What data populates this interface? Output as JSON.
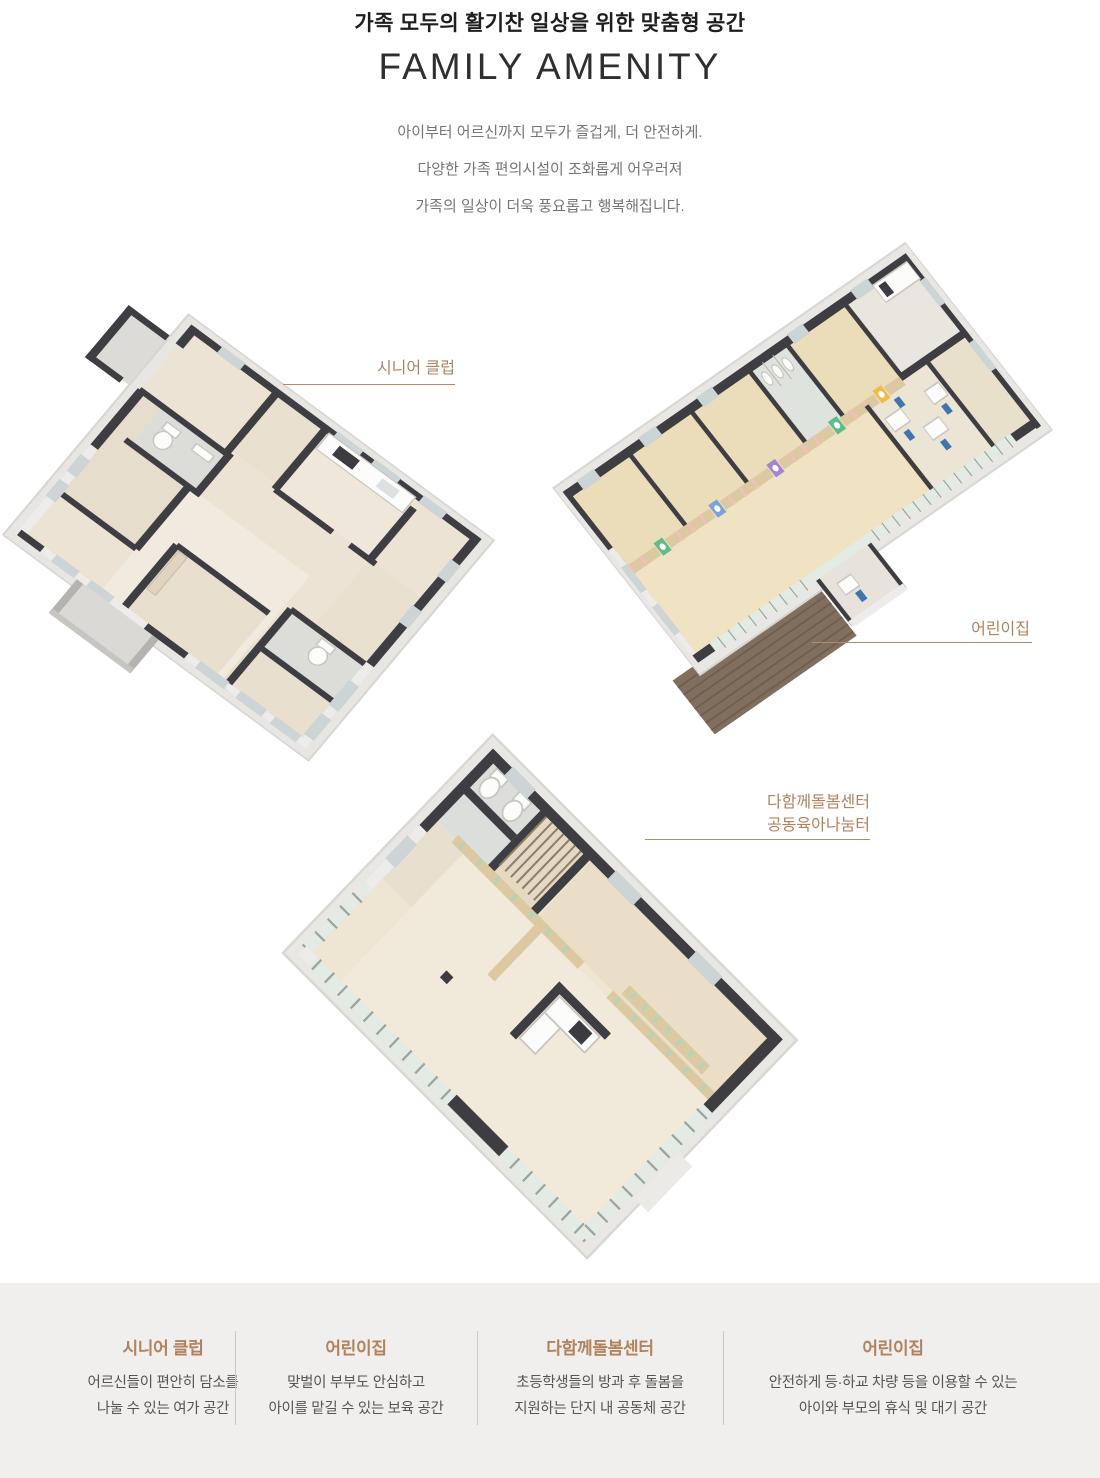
{
  "header": {
    "eyebrow": "가족 모두의 활기찬 일상을 위한 맞춤형 공간",
    "title": "FAMILY AMENITY",
    "description": [
      "아이부터 어르신까지 모두가 즐겁게, 더 안전하게.",
      "다양한 가족 편의시설이 조화롭게 어우러져",
      "가족의 일상이 더욱 풍요롭고 행복해집니다."
    ]
  },
  "callouts": [
    {
      "id": "senior-club",
      "label_lines": [
        "시니어 클럽"
      ]
    },
    {
      "id": "daycare",
      "label_lines": [
        "어린이집"
      ]
    },
    {
      "id": "care-center",
      "label_lines": [
        "다함께돌봄센터",
        "공동육아나눔터"
      ]
    }
  ],
  "footer": {
    "items": [
      {
        "title": "시니어 클럽",
        "desc": [
          "어르신들이 편안히 담소를",
          "나눌 수 있는 여가 공간"
        ]
      },
      {
        "title": "어린이집",
        "desc": [
          "맞벌이 부부도 안심하고",
          "아이를 맡길 수 있는 보육 공간"
        ]
      },
      {
        "title": "다함께돌봄센터",
        "desc": [
          "초등학생들의 방과 후 돌봄을",
          "지원하는 단지 내 공동체 공간"
        ]
      },
      {
        "title": "어린이집",
        "desc": [
          "안전하게 등·하교 차량 등을 이용할 수 있는",
          "아이와 부모의 휴식 및 대기 공간"
        ]
      }
    ]
  },
  "colors": {
    "accent_brown": "#b1825e",
    "callout_line": "#b58a68",
    "heading_dark": "#1e1e1e",
    "title_dark": "#2f2f2f",
    "body_gray": "#757575",
    "footer_bg": "#f0efed",
    "footer_text": "#555555",
    "wall_cap": "#3e3d42",
    "floor_beige": "#ece3d4",
    "daycare_floor": "#ebdcba",
    "deck_brown": "#806f5e",
    "glass_green": "#e3ebe5"
  }
}
